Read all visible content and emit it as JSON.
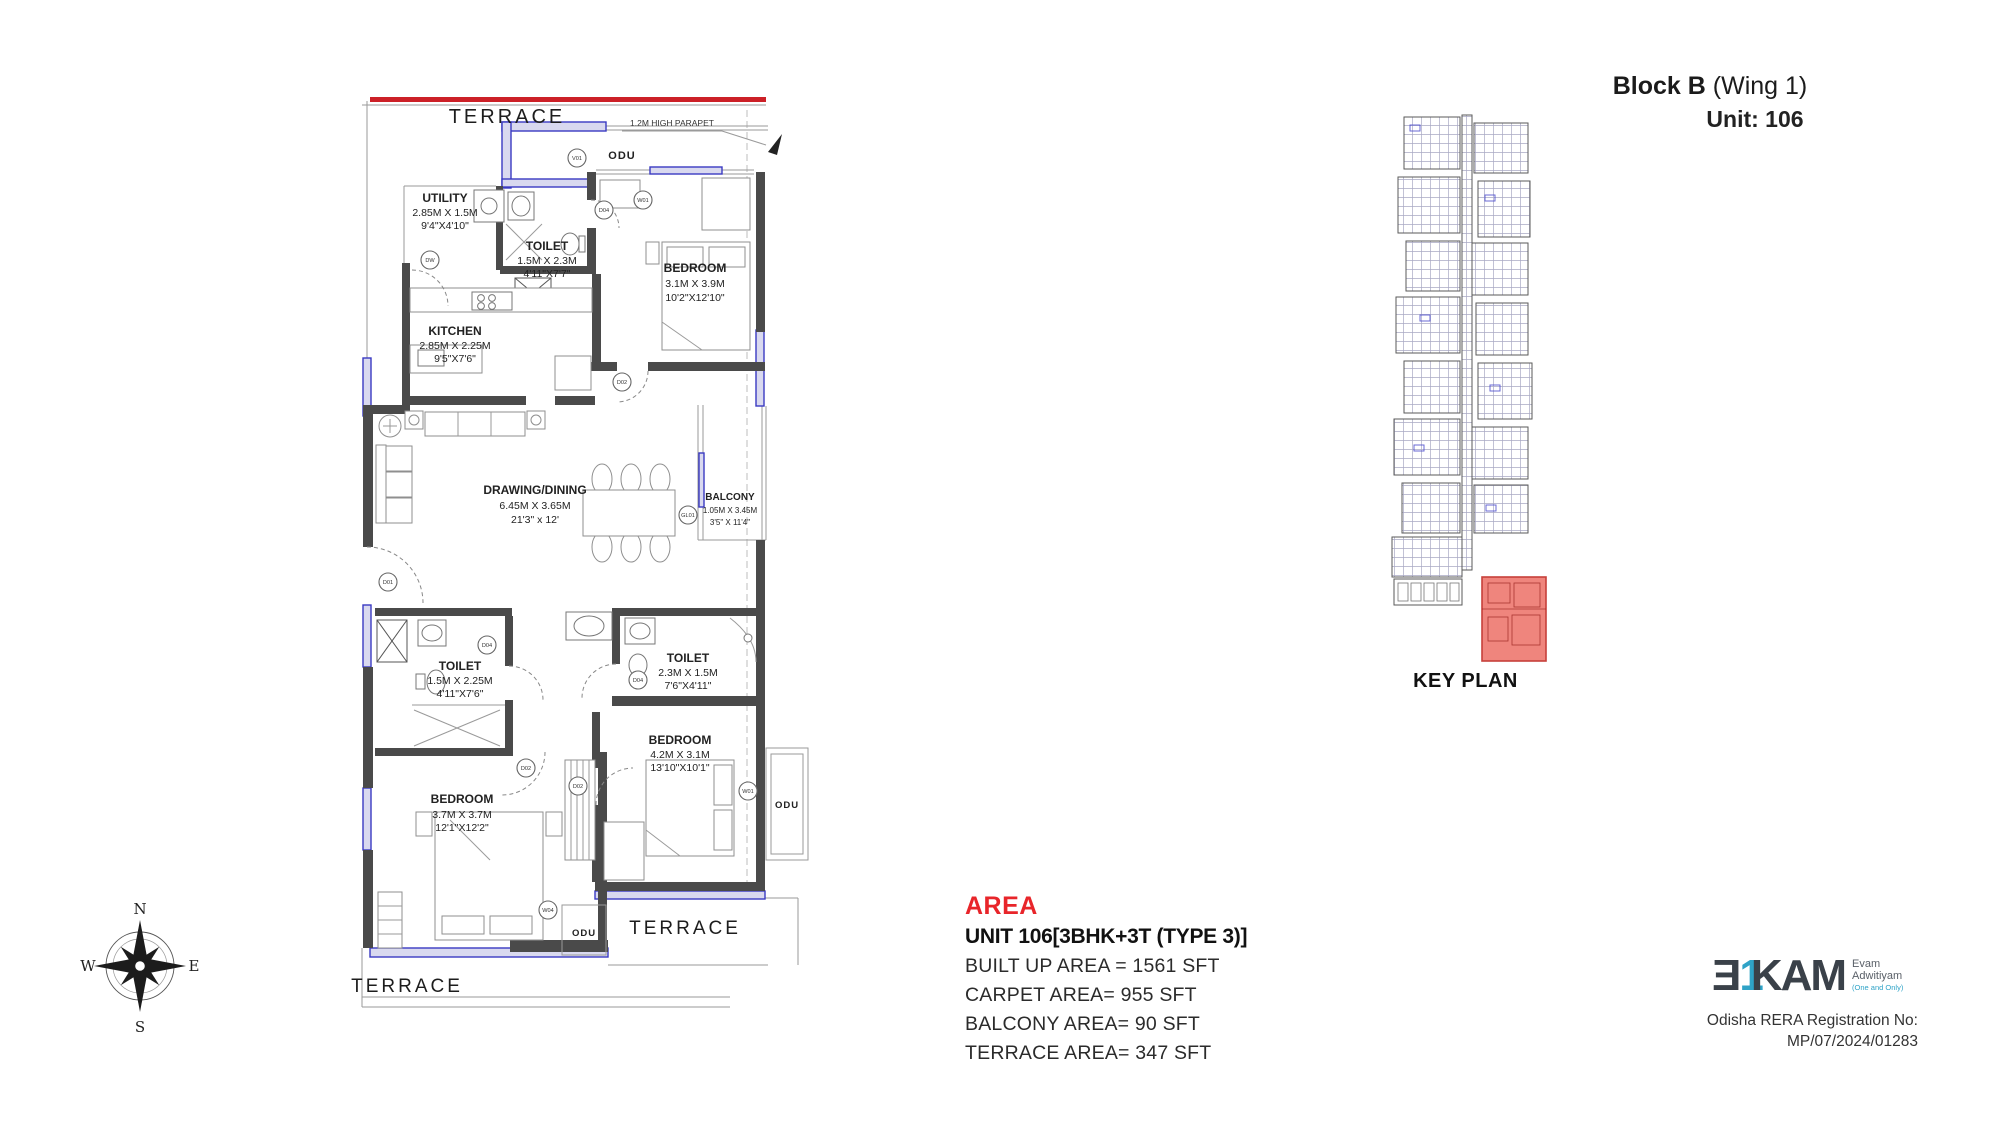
{
  "header": {
    "block": "Block B",
    "wing": " (Wing 1)",
    "unit": "Unit: 106"
  },
  "plan": {
    "terrace_top": "TERRACE",
    "terrace_bottom_left": "TERRACE",
    "terrace_bottom_right": "TERRACE",
    "parapet": "1.2M HIGH PARAPET",
    "odu_top": "ODU",
    "odu_right": "ODU",
    "odu_bottom": "ODU",
    "rooms": {
      "utility": {
        "name": "UTILITY",
        "m": "2.85M X 1.5M",
        "ft": "9'4\"X4'10\""
      },
      "toilet1": {
        "name": "TOILET",
        "m": "1.5M X 2.3M",
        "ft": "4'11\"X7'7\""
      },
      "bedroom1": {
        "name": "BEDROOM",
        "m": "3.1M X 3.9M",
        "ft": "10'2\"X12'10\""
      },
      "kitchen": {
        "name": "KITCHEN",
        "m": "2.85M X 2.25M",
        "ft": "9'5\"X7'6\""
      },
      "drawing": {
        "name": "DRAWING/DINING",
        "m": "6.45M X 3.65M",
        "ft": "21'3\" x 12'"
      },
      "balcony": {
        "name": "BALCONY",
        "m": "1.05M X 3.45M",
        "ft": "3'5\" X 11'4\""
      },
      "toilet2": {
        "name": "TOILET",
        "m": "1.5M X 2.25M",
        "ft": "4'11\"X7'6\""
      },
      "toilet3": {
        "name": "TOILET",
        "m": "2.3M X 1.5M",
        "ft": "7'6\"X4'11\""
      },
      "bedroom2": {
        "name": "BEDROOM",
        "m": "4.2M X 3.1M",
        "ft": "13'10\"X10'1\""
      },
      "bedroom3": {
        "name": "BEDROOM",
        "m": "3.7M X 3.7M",
        "ft": "12'1\"X12'2\""
      }
    },
    "tags": {
      "v01": "V01",
      "w01": "W01",
      "w04": "W04",
      "dw": "DW",
      "d01": "D01",
      "d02": "D02",
      "d04": "D04",
      "gl01": "GL01"
    }
  },
  "key_plan": {
    "label": "KEY PLAN"
  },
  "area": {
    "heading": "AREA",
    "unit_line": "UNIT 106[3BHK+3T (TYPE 3)]",
    "lines": [
      "BUILT UP AREA = 1561 SFT",
      "CARPET AREA= 955 SFT",
      "BALCONY AREA= 90 SFT",
      "TERRACE AREA= 347 SFT"
    ]
  },
  "compass": {
    "n": "N",
    "e": "E",
    "s": "S",
    "w": "W"
  },
  "footer": {
    "logo_e": "Ǝ",
    "logo_one": "1",
    "logo_kam": "KAM",
    "tag1": "Evam",
    "tag2": "Adwitiyam",
    "tag3": "(One and Only)",
    "rera1": "Odisha RERA Registration No:",
    "rera2": "MP/07/2024/01283"
  },
  "colors": {
    "red_line": "#cc2027",
    "area_red": "#e8252a",
    "wall": "#4a4a4a",
    "blue": "#3a3ac2",
    "keyplan_red": "#ee7b72",
    "logo_blue": "#2fa3c7",
    "logo_dark": "#3a4149"
  }
}
